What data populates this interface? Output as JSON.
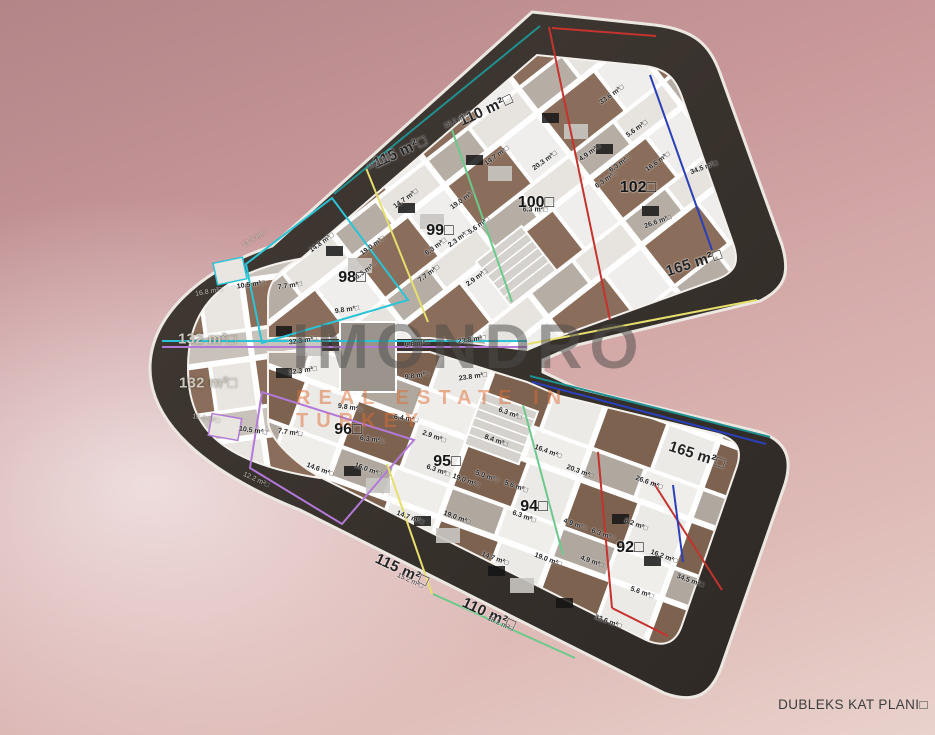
{
  "scene": {
    "caption": "DUBLEKS KAT PLANI□",
    "watermark": {
      "brand": "IMONDRO",
      "subtitle": "REAL ESTATE IN TURKEY",
      "brand_color": "#4e4c4a",
      "subtitle_color": "#dd6c34"
    }
  },
  "floor_plan": {
    "type": "duplex-floor-plan",
    "building_shape": "C-shaped block, rounded left cap, notch opening on right",
    "shell_color": "#38322e",
    "floor_light_color": "#e3dfda",
    "wood_color": "#8a6d5a",
    "outline_colors": {
      "cyan": "#2ac4d6",
      "purple": "#b279d8",
      "yellow": "#e6df6e",
      "green": "#6cc98b",
      "red": "#c4332e",
      "blue": "#2a3fb8",
      "teal": "#1f8f8f"
    },
    "units": [
      {
        "n": "98□",
        "x": 352,
        "y": 278
      },
      {
        "n": "99□",
        "x": 440,
        "y": 231
      },
      {
        "n": "100□",
        "x": 536,
        "y": 203
      },
      {
        "n": "102□",
        "x": 638,
        "y": 188
      },
      {
        "n": "96□",
        "x": 348,
        "y": 430
      },
      {
        "n": "95□",
        "x": 447,
        "y": 462
      },
      {
        "n": "94□",
        "x": 534,
        "y": 507
      },
      {
        "n": "92□",
        "x": 630,
        "y": 548
      }
    ],
    "area_labels": [
      {
        "t": "110 m²□",
        "x": 486,
        "y": 110,
        "r": -25,
        "big": true
      },
      {
        "t": "115 m²□",
        "x": 400,
        "y": 152,
        "r": -25,
        "big": true
      },
      {
        "t": "132 m²□",
        "x": 207,
        "y": 339,
        "r": 0,
        "big": true,
        "light": true
      },
      {
        "t": "132 m²□",
        "x": 208,
        "y": 383,
        "r": 0,
        "big": true,
        "light": true
      },
      {
        "t": "165 m²□",
        "x": 694,
        "y": 263,
        "r": -18,
        "big": true
      },
      {
        "t": "165 m²□",
        "x": 697,
        "y": 455,
        "r": 18,
        "big": true
      },
      {
        "t": "115 m²□",
        "x": 402,
        "y": 570,
        "r": 25,
        "big": true
      },
      {
        "t": "110 m²□",
        "x": 489,
        "y": 614,
        "r": 25,
        "big": true
      },
      {
        "t": "18.2 m²□",
        "x": 457,
        "y": 121,
        "r": -25,
        "small": true
      },
      {
        "t": "16.2 m²□",
        "x": 380,
        "y": 162,
        "r": -25,
        "small": true
      },
      {
        "t": "13.3 m²□",
        "x": 255,
        "y": 239,
        "r": -30,
        "small": true,
        "light": true
      },
      {
        "t": "16.8 m²□",
        "x": 209,
        "y": 292,
        "r": -10,
        "small": true,
        "light": true
      },
      {
        "t": "16.8 m²□",
        "x": 206,
        "y": 419,
        "r": 10,
        "small": true,
        "light": true
      },
      {
        "t": "12.2 m²□",
        "x": 256,
        "y": 480,
        "r": 25,
        "small": true,
        "light": true
      },
      {
        "t": "15.2 m²□",
        "x": 410,
        "y": 581,
        "r": 25,
        "small": true
      },
      {
        "t": "18.2 m²□",
        "x": 500,
        "y": 624,
        "r": 25,
        "small": true
      }
    ],
    "rooms": [
      {
        "t": "33.6 m²□",
        "x": 612,
        "y": 95,
        "r": -36
      },
      {
        "t": "5.6 m²□",
        "x": 637,
        "y": 129,
        "r": -36
      },
      {
        "t": "4.9 m²□",
        "x": 590,
        "y": 153,
        "r": -36
      },
      {
        "t": "16.6 m²□",
        "x": 658,
        "y": 162,
        "r": -36
      },
      {
        "t": "6.3 m²□",
        "x": 620,
        "y": 164,
        "r": -36
      },
      {
        "t": "6.3 m²□",
        "x": 606,
        "y": 180,
        "r": -36
      },
      {
        "t": "34.5 m²□",
        "x": 704,
        "y": 168,
        "r": -20
      },
      {
        "t": "26.6 m²□",
        "x": 658,
        "y": 222,
        "r": -20
      },
      {
        "t": "14.7 m²□",
        "x": 497,
        "y": 156,
        "r": -36
      },
      {
        "t": "20.3 m²□",
        "x": 545,
        "y": 161,
        "r": -36
      },
      {
        "t": "19.0 m²□",
        "x": 463,
        "y": 200,
        "r": -36
      },
      {
        "t": "14.7 m²□",
        "x": 406,
        "y": 199,
        "r": -36
      },
      {
        "t": "5.6 m²□",
        "x": 479,
        "y": 226,
        "r": -36
      },
      {
        "t": "2.3 m²□",
        "x": 459,
        "y": 239,
        "r": -36
      },
      {
        "t": "6.3 m²□",
        "x": 436,
        "y": 247,
        "r": -36
      },
      {
        "t": "6.3 m²□",
        "x": 535,
        "y": 210,
        "r": 0
      },
      {
        "t": "14.8 m²□",
        "x": 322,
        "y": 243,
        "r": -36
      },
      {
        "t": "19.0 m²□",
        "x": 373,
        "y": 246,
        "r": -36
      },
      {
        "t": "6.3 m²□",
        "x": 366,
        "y": 271,
        "r": -36
      },
      {
        "t": "7.7 m²□",
        "x": 429,
        "y": 274,
        "r": -36
      },
      {
        "t": "2.9 m²□",
        "x": 477,
        "y": 278,
        "r": -36
      },
      {
        "t": "10.5 m²□",
        "x": 251,
        "y": 285,
        "r": -8
      },
      {
        "t": "7.7 m²□",
        "x": 290,
        "y": 286,
        "r": -8
      },
      {
        "t": "9.8 m²□",
        "x": 347,
        "y": 310,
        "r": -8
      },
      {
        "t": "32.3 m²□",
        "x": 303,
        "y": 341,
        "r": -8
      },
      {
        "t": "32.3 m²□",
        "x": 303,
        "y": 371,
        "r": -8
      },
      {
        "t": "9.8 m²□",
        "x": 417,
        "y": 344,
        "r": -8
      },
      {
        "t": "9.8 m²□",
        "x": 417,
        "y": 376,
        "r": -8
      },
      {
        "t": "23.8 m²□",
        "x": 472,
        "y": 340,
        "r": -8
      },
      {
        "t": "23.8 m²□",
        "x": 473,
        "y": 377,
        "r": -8
      },
      {
        "t": "9.8 m²□",
        "x": 350,
        "y": 408,
        "r": 8
      },
      {
        "t": "6.4 m²□",
        "x": 406,
        "y": 419,
        "r": 8
      },
      {
        "t": "6.3 m²□",
        "x": 510,
        "y": 414,
        "r": 20
      },
      {
        "t": "10.5 m²□",
        "x": 253,
        "y": 431,
        "r": 8
      },
      {
        "t": "7.7 m²□",
        "x": 290,
        "y": 433,
        "r": 8
      },
      {
        "t": "2.9 m²□",
        "x": 434,
        "y": 437,
        "r": 20
      },
      {
        "t": "8.4 m²□",
        "x": 496,
        "y": 441,
        "r": 20
      },
      {
        "t": "6.3 m²□",
        "x": 372,
        "y": 440,
        "r": 8
      },
      {
        "t": "14.6 m²□",
        "x": 320,
        "y": 470,
        "r": 20
      },
      {
        "t": "16.0 m²□",
        "x": 368,
        "y": 470,
        "r": 20
      },
      {
        "t": "6.3 m²□",
        "x": 438,
        "y": 471,
        "r": 20
      },
      {
        "t": "19.0 m²□",
        "x": 466,
        "y": 481,
        "r": 20
      },
      {
        "t": "5.0 m²□",
        "x": 487,
        "y": 477,
        "r": 20
      },
      {
        "t": "5.6 m²□",
        "x": 516,
        "y": 487,
        "r": 20
      },
      {
        "t": "16.4 m²□",
        "x": 548,
        "y": 452,
        "r": 20
      },
      {
        "t": "20.3 m²□",
        "x": 580,
        "y": 472,
        "r": 20
      },
      {
        "t": "6.3 m²□",
        "x": 524,
        "y": 517,
        "r": 20
      },
      {
        "t": "14.7 m²□",
        "x": 410,
        "y": 518,
        "r": 20
      },
      {
        "t": "19.0 m²□",
        "x": 457,
        "y": 518,
        "r": 20
      },
      {
        "t": "14.7 m²□",
        "x": 495,
        "y": 559,
        "r": 20
      },
      {
        "t": "19.0 m²□",
        "x": 548,
        "y": 560,
        "r": 20
      },
      {
        "t": "4.9 m²□",
        "x": 592,
        "y": 562,
        "r": 20
      },
      {
        "t": "4.9 m²□",
        "x": 575,
        "y": 525,
        "r": 20
      },
      {
        "t": "6.3 m²□",
        "x": 603,
        "y": 535,
        "r": 20
      },
      {
        "t": "6.2 m²□",
        "x": 636,
        "y": 525,
        "r": 20
      },
      {
        "t": "16.2 m²□",
        "x": 664,
        "y": 557,
        "r": 20
      },
      {
        "t": "26.6 m²□",
        "x": 649,
        "y": 483,
        "r": 20
      },
      {
        "t": "5.6 m²□",
        "x": 642,
        "y": 593,
        "r": 20
      },
      {
        "t": "34.5 m²□",
        "x": 690,
        "y": 581,
        "r": 20
      },
      {
        "t": "33.6 m²□",
        "x": 608,
        "y": 622,
        "r": 20
      }
    ]
  }
}
